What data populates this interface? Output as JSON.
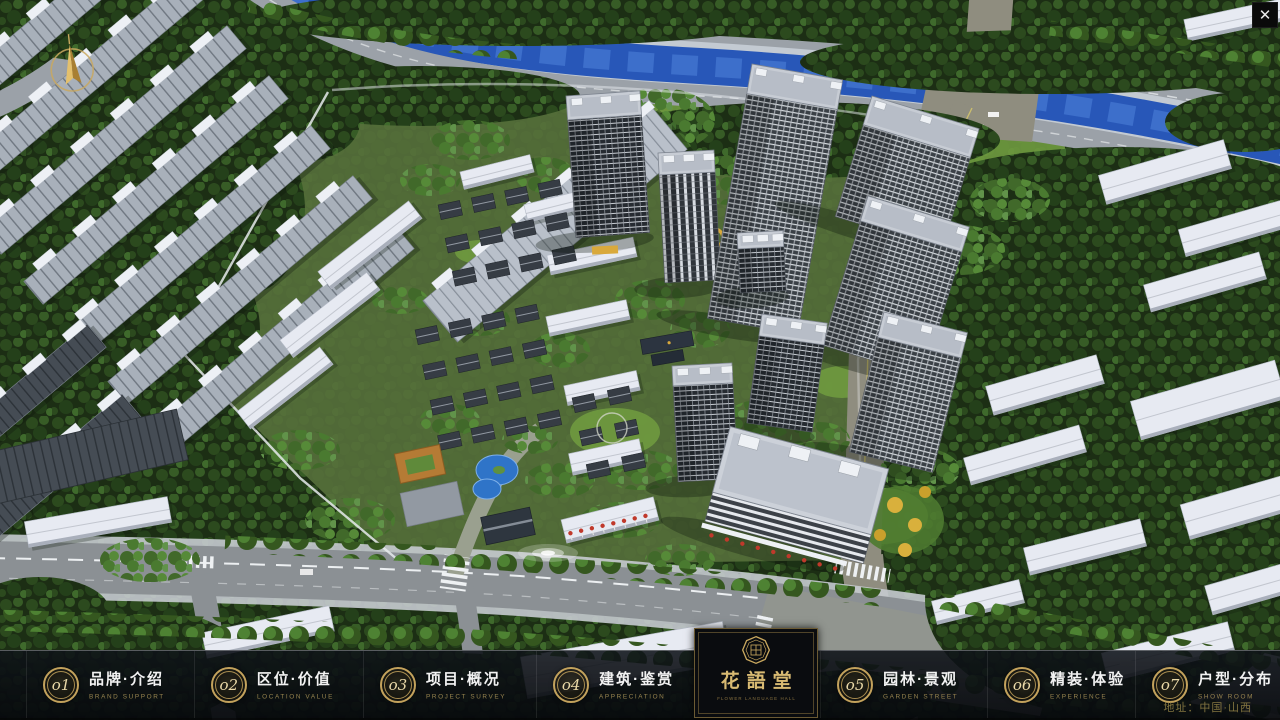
{
  "window": {
    "close_glyph": "✕"
  },
  "compass": {
    "name": "north-compass"
  },
  "menu": {
    "items": [
      {
        "num": "o1",
        "zh": "品牌·介绍",
        "en": "BRAND SUPPORT"
      },
      {
        "num": "o2",
        "zh": "区位·价值",
        "en": "LOCATION VALUE"
      },
      {
        "num": "o3",
        "zh": "项目·概况",
        "en": "PROJECT SURVEY"
      },
      {
        "num": "o4",
        "zh": "建筑·鉴赏",
        "en": "APPRECIATION"
      },
      {
        "num": "o5",
        "zh": "园林·景观",
        "en": "GARDEN STREET"
      },
      {
        "num": "o6",
        "zh": "精装·体验",
        "en": "EXPERIENCE"
      },
      {
        "num": "o7",
        "zh": "户型·分布",
        "en": "SHOW ROOM"
      },
      {
        "num": "o8",
        "zh": "一房·一景",
        "en": "COMMUNITY"
      }
    ]
  },
  "logo": {
    "emblem": "octagon-seal-icon",
    "title": "花語堂",
    "subtitle": "FLOWER LANGUAGE HALL"
  },
  "footer": {
    "address": "地址：中国·山西"
  },
  "colors": {
    "gold": "#c3a25c",
    "menu_text": "#f2f2f2",
    "menu_en": "#97834f",
    "river": "#2857b8"
  }
}
